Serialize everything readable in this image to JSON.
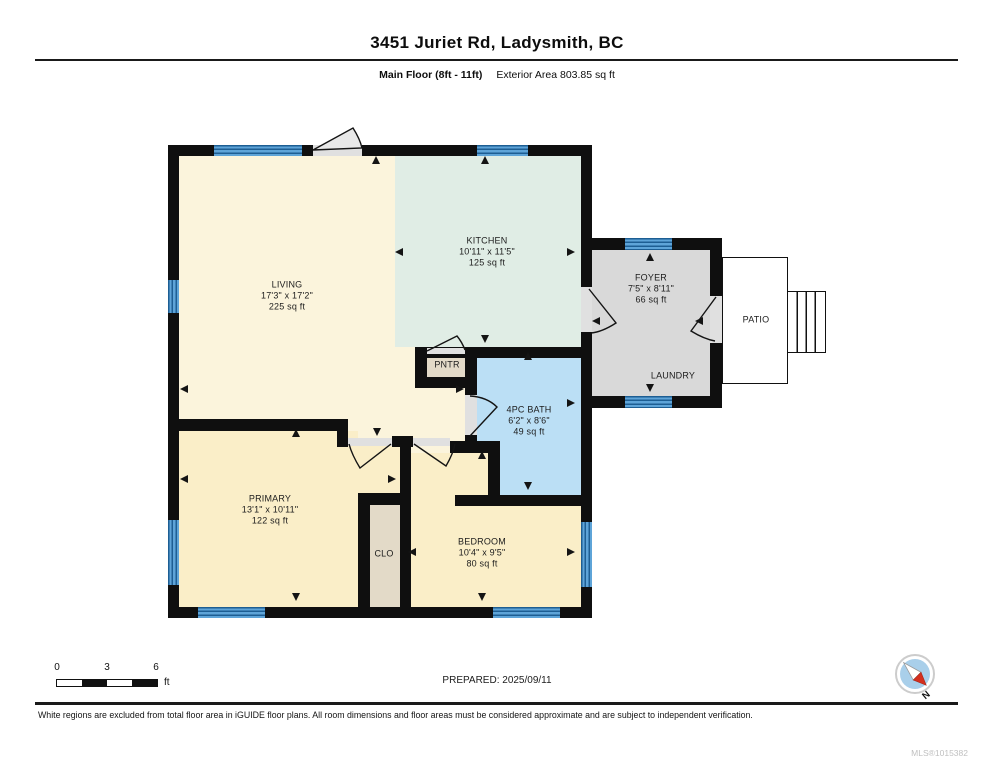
{
  "header": {
    "title": "3451 Juriet Rd, Ladysmith, BC",
    "floor_label": "Main Floor (8ft - 11ft)",
    "exterior_area_label": "Exterior Area 803.85 sq ft"
  },
  "floorplan": {
    "rooms": [
      {
        "id": "living",
        "name": "LIVING",
        "dims": "17'3\" x 17'2\"",
        "area": "225 sq ft",
        "color": "#FBF4DC"
      },
      {
        "id": "kitchen",
        "name": "KITCHEN",
        "dims": "10'11\" x 11'5\"",
        "area": "125 sq ft",
        "color": "#E0EDE5"
      },
      {
        "id": "foyer",
        "name": "FOYER",
        "dims": "7'5\" x 8'11\"",
        "area": "66 sq ft",
        "color": "#D9D9D9"
      },
      {
        "id": "laundry",
        "name": "LAUNDRY",
        "color": "#D9D9D9"
      },
      {
        "id": "patio",
        "name": "PATIO",
        "color": "#FFFFFF"
      },
      {
        "id": "pantry",
        "name": "PNTR",
        "color": "#E3DAC8"
      },
      {
        "id": "bath",
        "name": "4PC BATH",
        "dims": "6'2\" x 8'6\"",
        "area": "49 sq ft",
        "color": "#BBDFF5"
      },
      {
        "id": "primary",
        "name": "PRIMARY",
        "dims": "13'1\" x 10'11\"",
        "area": "122 sq ft",
        "color": "#FAEEC8"
      },
      {
        "id": "closet",
        "name": "CLO",
        "color": "#E3DAC8"
      },
      {
        "id": "bedroom",
        "name": "BEDROOM",
        "dims": "10'4\" x 9'5\"",
        "area": "80 sq ft",
        "color": "#FAEEC8"
      }
    ],
    "colors": {
      "wall": "#0f0f0f",
      "window_base": "#5EA4D8",
      "window_stripe": "#1D5E93",
      "door": "#E0E0E0",
      "swing_fill": "#E8E8E8"
    }
  },
  "scale_bar": {
    "tick_labels": [
      "0",
      "3",
      "6"
    ],
    "unit": "ft"
  },
  "prepared_label": "PREPARED: 2025/09/11",
  "compass": {
    "label": "N"
  },
  "footer": {
    "disclaimer": "White regions are excluded from total floor area in iGUIDE floor plans. All room dimensions and floor areas must be considered approximate and are subject to independent verification.",
    "mls_number": "MLS®1015382"
  }
}
